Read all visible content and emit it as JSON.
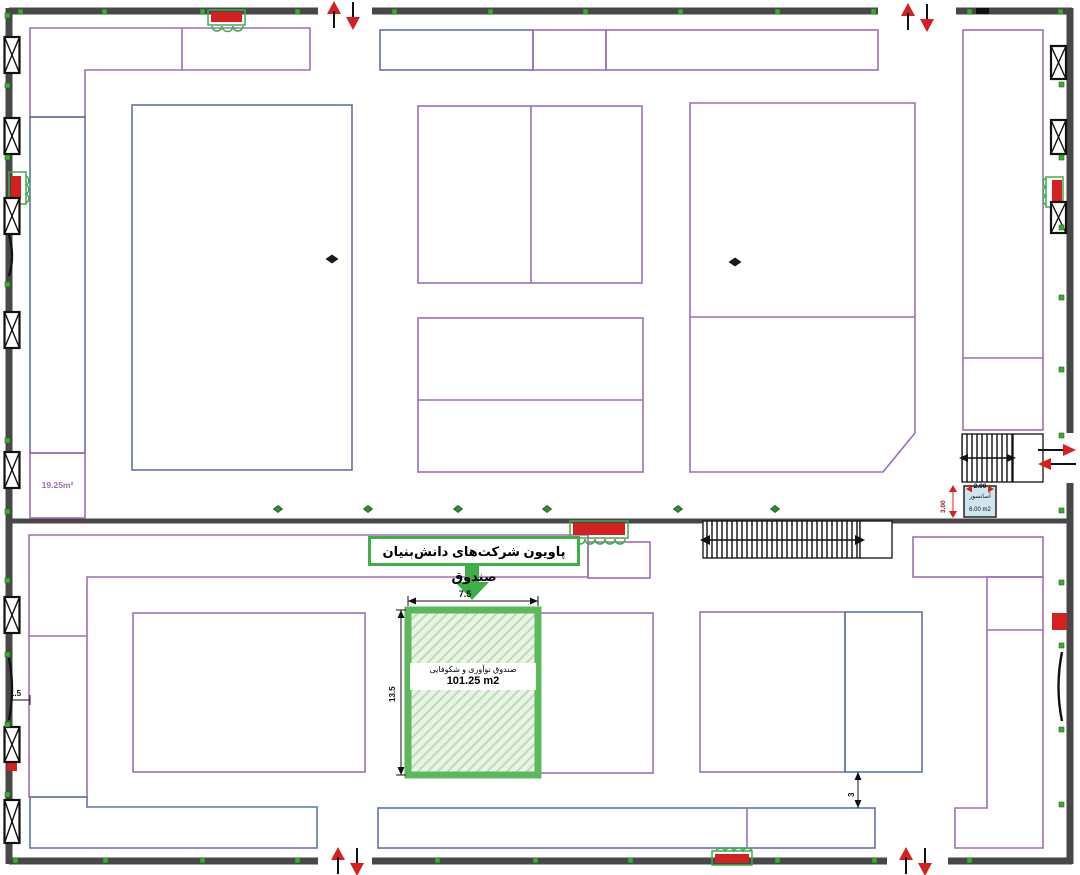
{
  "labels": {
    "pavilion": "پاویون شرکت‌های دانش‌بنیان صندوق",
    "booth_name": "صندوق نوآوری و شکوفایی",
    "booth_area": "101.25 m2",
    "booth_width": "7.5",
    "booth_height": "13.5",
    "corner_area": "19.25m²",
    "aisle_dim": "3",
    "left_offset_dim": "1.5",
    "elev_width": "2.00",
    "elev_height": "3.00",
    "elev_name": "آسانسور",
    "elev_area": "6.00 m2"
  },
  "colors": {
    "booth_outline_purple": "#9d6fb4",
    "booth_outline_blue": "#5f72ad",
    "wall_gray": "#474747",
    "highlight_green_border": "#5cb85c",
    "highlight_green_fill": "#e9f3e6",
    "label_box_green": "#3fae49",
    "marker_green": "#3faa35",
    "diamond_green": "#2f8c2f",
    "arrow_red": "#d42020",
    "elevator_fill": "#cfe6ee"
  }
}
